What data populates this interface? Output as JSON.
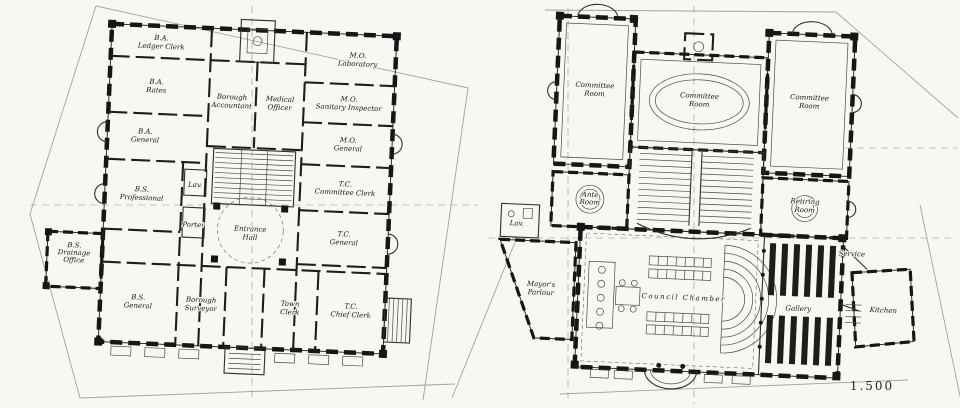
{
  "drawing": {
    "kind": "architectural-floor-plans",
    "scale_label": "1.500",
    "ink_color": "#161614",
    "paper_color": "#f7f7f4"
  },
  "plans": [
    {
      "name": "ground-floor",
      "rooms": [
        {
          "id": "ba-ledger-clerk",
          "lines": [
            "B.A.",
            "Ledger Clerk"
          ],
          "x": 155,
          "y": 46
        },
        {
          "id": "ba-rates",
          "lines": [
            "B.A.",
            "Rates"
          ],
          "x": 152,
          "y": 90
        },
        {
          "id": "borough-accountant",
          "lines": [
            "Borough",
            "Accountant"
          ],
          "x": 228,
          "y": 102
        },
        {
          "id": "medical-officer",
          "lines": [
            "Medical",
            "Officer"
          ],
          "x": 276,
          "y": 102
        },
        {
          "id": "mo-laboratory",
          "lines": [
            "M.O.",
            "Laboratory"
          ],
          "x": 352,
          "y": 55
        },
        {
          "id": "mo-sanitary-inspector",
          "lines": [
            "M.O.",
            "Sanitary Inspector"
          ],
          "x": 345,
          "y": 99
        },
        {
          "id": "mo-general",
          "lines": [
            "M.O.",
            "General"
          ],
          "x": 346,
          "y": 140
        },
        {
          "id": "ba-general",
          "lines": [
            "B.A.",
            "General"
          ],
          "x": 143,
          "y": 140
        },
        {
          "id": "tc-committee-clerk",
          "lines": [
            "T.C.",
            "Committee Clerk"
          ],
          "x": 345,
          "y": 184
        },
        {
          "id": "bs-professional",
          "lines": [
            "B.S.",
            "Professional"
          ],
          "x": 142,
          "y": 198
        },
        {
          "id": "lav-ground",
          "lines": [
            "Lav."
          ],
          "x": 195,
          "y": 187,
          "size": 5
        },
        {
          "id": "porter",
          "lines": [
            "Porter"
          ],
          "x": 195,
          "y": 227,
          "size": 5
        },
        {
          "id": "entrance-hall",
          "lines": [
            "Entrance",
            "Hall"
          ],
          "x": 252,
          "y": 233
        },
        {
          "id": "tc-general",
          "lines": [
            "T.C.",
            "General"
          ],
          "x": 346,
          "y": 234
        },
        {
          "id": "bs-drainage-office",
          "lines": [
            "B.S.",
            "Drainage",
            "Office"
          ],
          "x": 77,
          "y": 260,
          "size": 6
        },
        {
          "id": "bs-general",
          "lines": [
            "B.S.",
            "General"
          ],
          "x": 143,
          "y": 306
        },
        {
          "id": "borough-surveyor",
          "lines": [
            "Borough",
            "Surveyor"
          ],
          "x": 206,
          "y": 306
        },
        {
          "id": "town-clerk",
          "lines": [
            "Town",
            "Clerk"
          ],
          "x": 295,
          "y": 306
        },
        {
          "id": "tc-chief-clerk",
          "lines": [
            "T.C.",
            "Chief Clerk"
          ],
          "x": 356,
          "y": 306
        }
      ]
    },
    {
      "name": "first-floor",
      "rooms": [
        {
          "id": "committee-room-left",
          "lines": [
            "Committee",
            "Room"
          ],
          "x": 590,
          "y": 94
        },
        {
          "id": "committee-room-centre",
          "lines": [
            "Committee",
            "Room"
          ],
          "x": 695,
          "y": 100
        },
        {
          "id": "committee-room-right",
          "lines": [
            "Committee",
            "Room"
          ],
          "x": 805,
          "y": 97
        },
        {
          "id": "ante-room",
          "lines": [
            "Ante",
            "Room"
          ],
          "x": 590,
          "y": 203,
          "size": 6
        },
        {
          "id": "retiring-room",
          "lines": [
            "Retiring",
            "Room"
          ],
          "x": 805,
          "y": 201
        },
        {
          "id": "lav-first",
          "lines": [
            "Lav."
          ],
          "x": 518,
          "y": 231,
          "size": 5
        },
        {
          "id": "mayors-parlour",
          "lines": [
            "Mayor's",
            "Parlour"
          ],
          "x": 545,
          "y": 295
        },
        {
          "id": "council-chamber",
          "lines": [
            "Council Chamber"
          ],
          "x": 688,
          "y": 298,
          "size": 12
        },
        {
          "id": "gallery",
          "lines": [
            "Gallery"
          ],
          "x": 803,
          "y": 304,
          "size": 6.5
        },
        {
          "id": "kitchen",
          "lines": [
            "Kitchen"
          ],
          "x": 888,
          "y": 302,
          "size": 6.5
        },
        {
          "id": "service",
          "lines": [
            "Service"
          ],
          "x": 854,
          "y": 247,
          "size": 5
        }
      ]
    }
  ]
}
